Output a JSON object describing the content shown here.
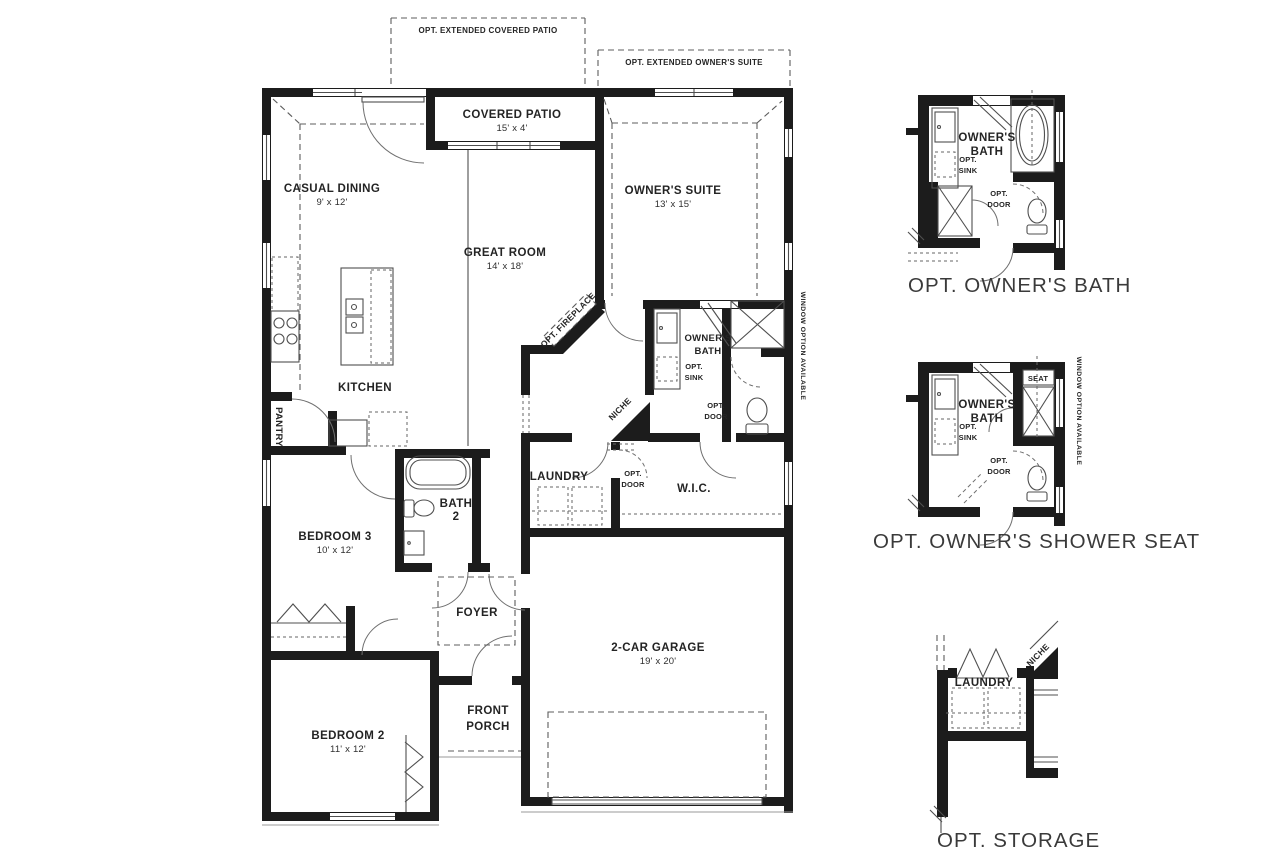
{
  "colors": {
    "wall": "#1c1c1c",
    "line": "#4f4f4f",
    "dash": "#5c5c5c",
    "text": "#242424",
    "caption": "#3a3a3a",
    "background": "#ffffff"
  },
  "main": {
    "options": {
      "opt_extended_covered_patio": "OPT. EXTENDED COVERED PATIO",
      "opt_extended_owners_suite": "OPT. EXTENDED OWNER'S SUITE",
      "opt_fireplace": "OPT. FIREPLACE",
      "niche": "NICHE",
      "window_option": "WINDOW OPTION AVAILABLE"
    },
    "rooms": {
      "casual_dining": {
        "name": "CASUAL DINING",
        "dims": "9' x 12'"
      },
      "covered_patio": {
        "name": "COVERED PATIO",
        "dims": "15' x 4'"
      },
      "great_room": {
        "name": "GREAT ROOM",
        "dims": "14' x 18'"
      },
      "owners_suite": {
        "name": "OWNER'S SUITE",
        "dims": "13' x 15'"
      },
      "kitchen": {
        "name": "KITCHEN"
      },
      "pantry": {
        "name": "PANTRY"
      },
      "owners_bath": {
        "line1": "OWNER'S",
        "line2": "BATH"
      },
      "laundry": {
        "name": "LAUNDRY"
      },
      "wic": {
        "name": "W.I.C."
      },
      "bath2": {
        "line1": "BATH",
        "line2": "2"
      },
      "bedroom3": {
        "name": "BEDROOM 3",
        "dims": "10' x 12'"
      },
      "foyer": {
        "name": "FOYER"
      },
      "front_porch": {
        "line1": "FRONT",
        "line2": "PORCH"
      },
      "bedroom2": {
        "name": "BEDROOM 2",
        "dims": "11' x 12'"
      },
      "garage": {
        "name": "2-CAR GARAGE",
        "dims": "19' x 20'"
      }
    }
  },
  "words": {
    "opt": "OPT.",
    "sink": "SINK",
    "door": "DOOR",
    "seat": "SEAT"
  },
  "insets": {
    "owners_bath": {
      "caption": "OPT. OWNER'S BATH"
    },
    "shower_seat": {
      "caption": "OPT. OWNER'S SHOWER SEAT"
    },
    "storage": {
      "caption": "OPT. STORAGE"
    }
  }
}
